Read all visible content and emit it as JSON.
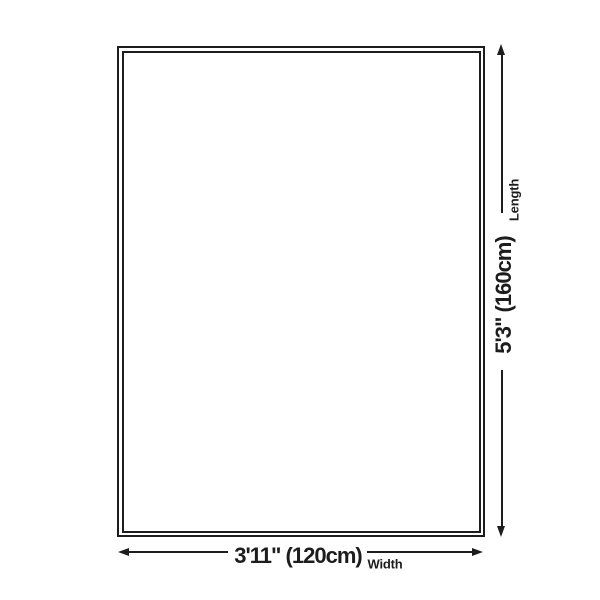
{
  "diagram": {
    "type": "product-size-diagram",
    "dimensions": {
      "length": {
        "value": "5'3\" (160cm)",
        "label": "Length"
      },
      "width": {
        "value": "3'11\" (120cm)",
        "label": "Width"
      }
    },
    "colors": {
      "line": "#1d1d1d",
      "background": "#ffffff"
    }
  }
}
